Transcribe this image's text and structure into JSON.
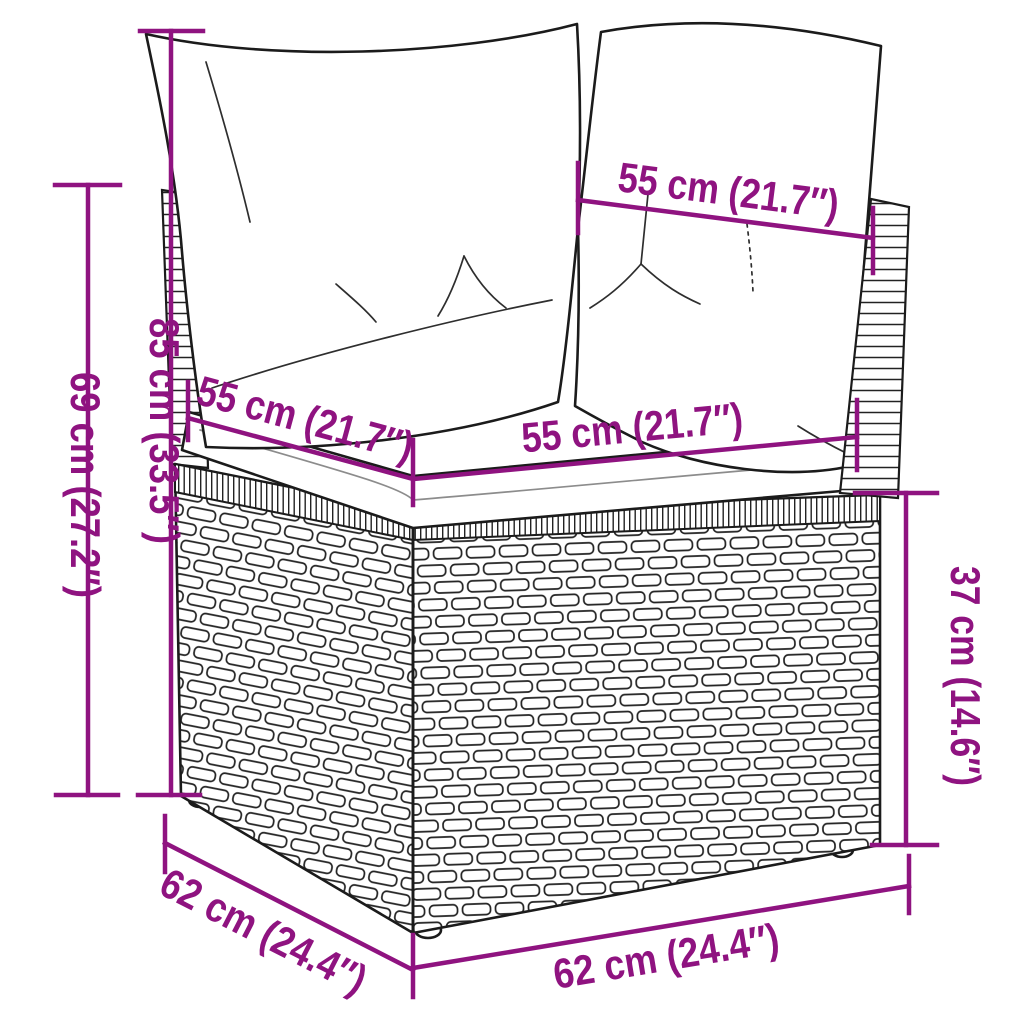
{
  "diagram": {
    "subject": "rattan corner sofa module with back cushions and seat cushion",
    "background_color": "#ffffff",
    "drawing_line_color": "#1b1b1b",
    "dimension_color": "#8F1380"
  },
  "dimensions": [
    {
      "id": "back-width-top",
      "cm": 55,
      "inches": 21.7,
      "label": "55 cm (21.7″)"
    },
    {
      "id": "overall-height",
      "cm": 85,
      "inches": 33.5,
      "label": "85 cm (33.5″)"
    },
    {
      "id": "side-height",
      "cm": 69,
      "inches": 27.2,
      "label": "69 cm (27.2″)"
    },
    {
      "id": "seat-depth-left",
      "cm": 55,
      "inches": 21.7,
      "label": "55 cm (21.7″)"
    },
    {
      "id": "seat-width-front",
      "cm": 55,
      "inches": 21.7,
      "label": "55 cm (21.7″)"
    },
    {
      "id": "base-height",
      "cm": 37,
      "inches": 14.6,
      "label": "37 cm (14.6″)"
    },
    {
      "id": "base-depth-left",
      "cm": 62,
      "inches": 24.4,
      "label": "62 cm (24.4″)"
    },
    {
      "id": "base-width-front",
      "cm": 62,
      "inches": 24.4,
      "label": "62 cm (24.4″)"
    }
  ]
}
